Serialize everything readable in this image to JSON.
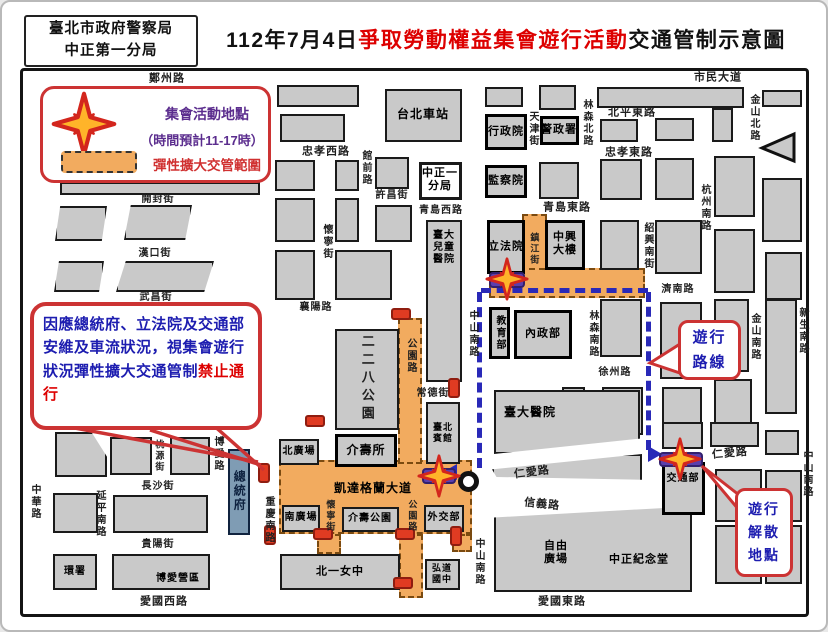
{
  "header": {
    "agency_line1": "臺北市政府警察局",
    "agency_line2": "中正第一分局",
    "title_prefix": "112年7月4日",
    "title_highlight": "爭取勞動權益集會遊行活動",
    "title_suffix": "交通管制示意圖"
  },
  "legend": {
    "star_label": "集會活動地點",
    "time_note": "（時間預計11-17時）",
    "zone_label": "彈性擴大交管範圍"
  },
  "notice": {
    "body": "因應總統府、立法院及交通部安維及車流狀況，視集會遊行狀況彈性擴大交通管制",
    "emphasis": "禁止通行"
  },
  "callouts": {
    "route": "遊行\n路線",
    "dissolution": "遊行\n解散\n地點"
  },
  "colors": {
    "accent_red": "#cc3333",
    "title_red": "#dd0000",
    "text_blue": "#1d1db0",
    "legend_purple": "#5b2d8e",
    "zone_orange": "#f2ab5f",
    "marker_purple": "#5a3fae",
    "route_blue": "#2929b8",
    "block_gray": "#c9c9c9",
    "gov_blue": "#7f9cb4"
  },
  "icons": {
    "assembly_star": "four-point-star",
    "control_zone": "orange-dashed-rectangle",
    "roadblock": "red-barricade",
    "parade_route": "blue-dashed-line",
    "roundabout": "black-ring-circle"
  },
  "map": {
    "labels": [
      {
        "t": "鄭州路",
        "x": 165,
        "y": 77
      },
      {
        "t": "市民大道",
        "x": 716,
        "y": 76
      },
      {
        "t": "北平東路",
        "x": 630,
        "y": 111
      },
      {
        "t": "忠孝東路",
        "x": 627,
        "y": 151
      },
      {
        "t": "林森北路",
        "x": 584,
        "y": 121,
        "v": 1,
        "fs": 10
      },
      {
        "t": "天津街",
        "x": 530,
        "y": 127,
        "v": 1,
        "fs": 10
      },
      {
        "t": "金山北路",
        "x": 751,
        "y": 116,
        "v": 1,
        "fs": 10
      },
      {
        "t": "杭州南路",
        "x": 702,
        "y": 206,
        "v": 1,
        "fs": 10
      },
      {
        "t": "忠孝西路",
        "x": 324,
        "y": 150
      },
      {
        "t": "館前路",
        "x": 363,
        "y": 166,
        "v": 1,
        "fs": 10
      },
      {
        "t": "許昌街",
        "x": 390,
        "y": 194,
        "fs": 10
      },
      {
        "t": "青島西路",
        "x": 439,
        "y": 209,
        "fs": 10
      },
      {
        "t": "青島東路",
        "x": 565,
        "y": 206
      },
      {
        "t": "紹興南街",
        "x": 645,
        "y": 244,
        "v": 1,
        "fs": 10
      },
      {
        "t": "開封街",
        "x": 156,
        "y": 198,
        "fs": 10
      },
      {
        "t": "漢口街",
        "x": 153,
        "y": 252,
        "fs": 10
      },
      {
        "t": "武昌街",
        "x": 154,
        "y": 296,
        "fs": 10
      },
      {
        "t": "襄陽路",
        "x": 314,
        "y": 306,
        "fs": 10
      },
      {
        "t": "懷寧街",
        "x": 324,
        "y": 240,
        "v": 1,
        "fs": 10
      },
      {
        "t": "濟南路",
        "x": 676,
        "y": 288,
        "fs": 10
      },
      {
        "t": "林森南路",
        "x": 590,
        "y": 332,
        "v": 1,
        "fs": 10
      },
      {
        "t": "徐州路",
        "x": 613,
        "y": 371,
        "fs": 10
      },
      {
        "t": "金山南路",
        "x": 752,
        "y": 335,
        "v": 1,
        "fs": 10
      },
      {
        "t": "新生南路",
        "x": 800,
        "y": 329,
        "v": 1,
        "fs": 10
      },
      {
        "t": "公園路",
        "x": 408,
        "y": 354,
        "v": 1,
        "fs": 10
      },
      {
        "t": "常德街",
        "x": 431,
        "y": 392,
        "fs": 10
      },
      {
        "t": "中山南路",
        "x": 470,
        "y": 332,
        "v": 1,
        "fs": 10
      },
      {
        "t": "鎮江街",
        "x": 532,
        "y": 247,
        "v": 1,
        "fs": 9
      },
      {
        "t": "寶慶路",
        "x": 156,
        "y": 425,
        "fs": 10
      },
      {
        "t": "桃源街",
        "x": 157,
        "y": 454,
        "v": 1,
        "fs": 9
      },
      {
        "t": "長沙街",
        "x": 156,
        "y": 485,
        "fs": 10
      },
      {
        "t": "中華路",
        "x": 32,
        "y": 500,
        "v": 1,
        "fs": 10
      },
      {
        "t": "延平南路",
        "x": 97,
        "y": 512,
        "v": 1,
        "fs": 10
      },
      {
        "t": "貴陽街",
        "x": 156,
        "y": 543,
        "fs": 10
      },
      {
        "t": "博愛路",
        "x": 215,
        "y": 452,
        "v": 1,
        "fs": 10
      },
      {
        "t": "重慶南路",
        "x": 266,
        "y": 518,
        "v": 1,
        "fs": 10
      },
      {
        "t": "凱達格蘭大道",
        "x": 371,
        "y": 486,
        "fs": 12,
        "c": "b"
      },
      {
        "t": "懷寧街",
        "x": 328,
        "y": 514,
        "v": 1,
        "fs": 9
      },
      {
        "t": "公園路",
        "x": 410,
        "y": 514,
        "v": 1,
        "fs": 9
      },
      {
        "t": "仁愛路",
        "x": 530,
        "y": 471,
        "r": -7,
        "fs": 11
      },
      {
        "t": "信義路",
        "x": 540,
        "y": 503,
        "r": 6,
        "fs": 11
      },
      {
        "t": "中山南路",
        "x": 476,
        "y": 560,
        "v": 1,
        "fs": 10
      },
      {
        "t": "愛國西路",
        "x": 162,
        "y": 600
      },
      {
        "t": "愛國東路",
        "x": 560,
        "y": 600
      },
      {
        "t": "仁愛路",
        "x": 728,
        "y": 452,
        "r": -5,
        "fs": 11
      },
      {
        "t": "中山南路",
        "x": 804,
        "y": 472,
        "v": 1,
        "fs": 10
      },
      {
        "t": "台北車站",
        "x": 421,
        "y": 112,
        "c": "b",
        "fs": 12
      },
      {
        "t": "行政院",
        "x": 504,
        "y": 130,
        "c": "bb",
        "fs": 11
      },
      {
        "t": "警政署",
        "x": 557,
        "y": 128,
        "c": "bb",
        "fs": 11
      },
      {
        "t": "監察院",
        "x": 504,
        "y": 179,
        "c": "bb",
        "fs": 11
      },
      {
        "t": "中正一分局",
        "x": 438,
        "y": 178,
        "c": "bb",
        "w": 40,
        "fs": 11
      },
      {
        "t": "立法院",
        "x": 504,
        "y": 245,
        "c": "bb",
        "fs": 11
      },
      {
        "t": "中興大樓",
        "x": 563,
        "y": 242,
        "c": "bb",
        "w": 28,
        "fs": 11
      },
      {
        "t": "教育部",
        "x": 497,
        "y": 331,
        "c": "bb",
        "v": 1,
        "fs": 10
      },
      {
        "t": "內政部",
        "x": 541,
        "y": 332,
        "c": "bb",
        "fs": 11
      },
      {
        "t": "臺大兒童醫院",
        "x": 442,
        "y": 246,
        "c": "b",
        "w": 26,
        "fs": 10
      },
      {
        "t": "二二八公園",
        "x": 365,
        "y": 377,
        "c": "pk",
        "v": 1,
        "fs": 13
      },
      {
        "t": "介壽所",
        "x": 364,
        "y": 448,
        "c": "bb",
        "fs": 12
      },
      {
        "t": "臺北賓館",
        "x": 441,
        "y": 431,
        "c": "b",
        "w": 24,
        "fs": 9
      },
      {
        "t": "總統府",
        "x": 237,
        "y": 489,
        "c": "gov",
        "v": 1,
        "fs": 12
      },
      {
        "t": "北廣場",
        "x": 297,
        "y": 450,
        "c": "b",
        "fs": 10
      },
      {
        "t": "南廣場",
        "x": 299,
        "y": 516,
        "c": "b",
        "fs": 10
      },
      {
        "t": "介壽公園",
        "x": 368,
        "y": 517,
        "c": "b",
        "fs": 10
      },
      {
        "t": "外交部",
        "x": 442,
        "y": 516,
        "c": "b",
        "fs": 10
      },
      {
        "t": "北一女中",
        "x": 338,
        "y": 570,
        "c": "b",
        "fs": 11
      },
      {
        "t": "弘道國中",
        "x": 440,
        "y": 572,
        "c": "b",
        "w": 24,
        "fs": 9
      },
      {
        "t": "臺大醫院",
        "x": 528,
        "y": 410,
        "c": "b",
        "fs": 12
      },
      {
        "t": "自由廣場",
        "x": 554,
        "y": 551,
        "c": "b",
        "w": 28,
        "fs": 11
      },
      {
        "t": "中正紀念堂",
        "x": 637,
        "y": 558,
        "c": "b",
        "fs": 11
      },
      {
        "t": "交通部",
        "x": 681,
        "y": 477,
        "c": "bb",
        "fs": 10
      },
      {
        "t": "環署",
        "x": 73,
        "y": 570,
        "c": "b",
        "fs": 10
      },
      {
        "t": "博愛營區",
        "x": 176,
        "y": 577,
        "c": "b",
        "fs": 10
      }
    ]
  }
}
